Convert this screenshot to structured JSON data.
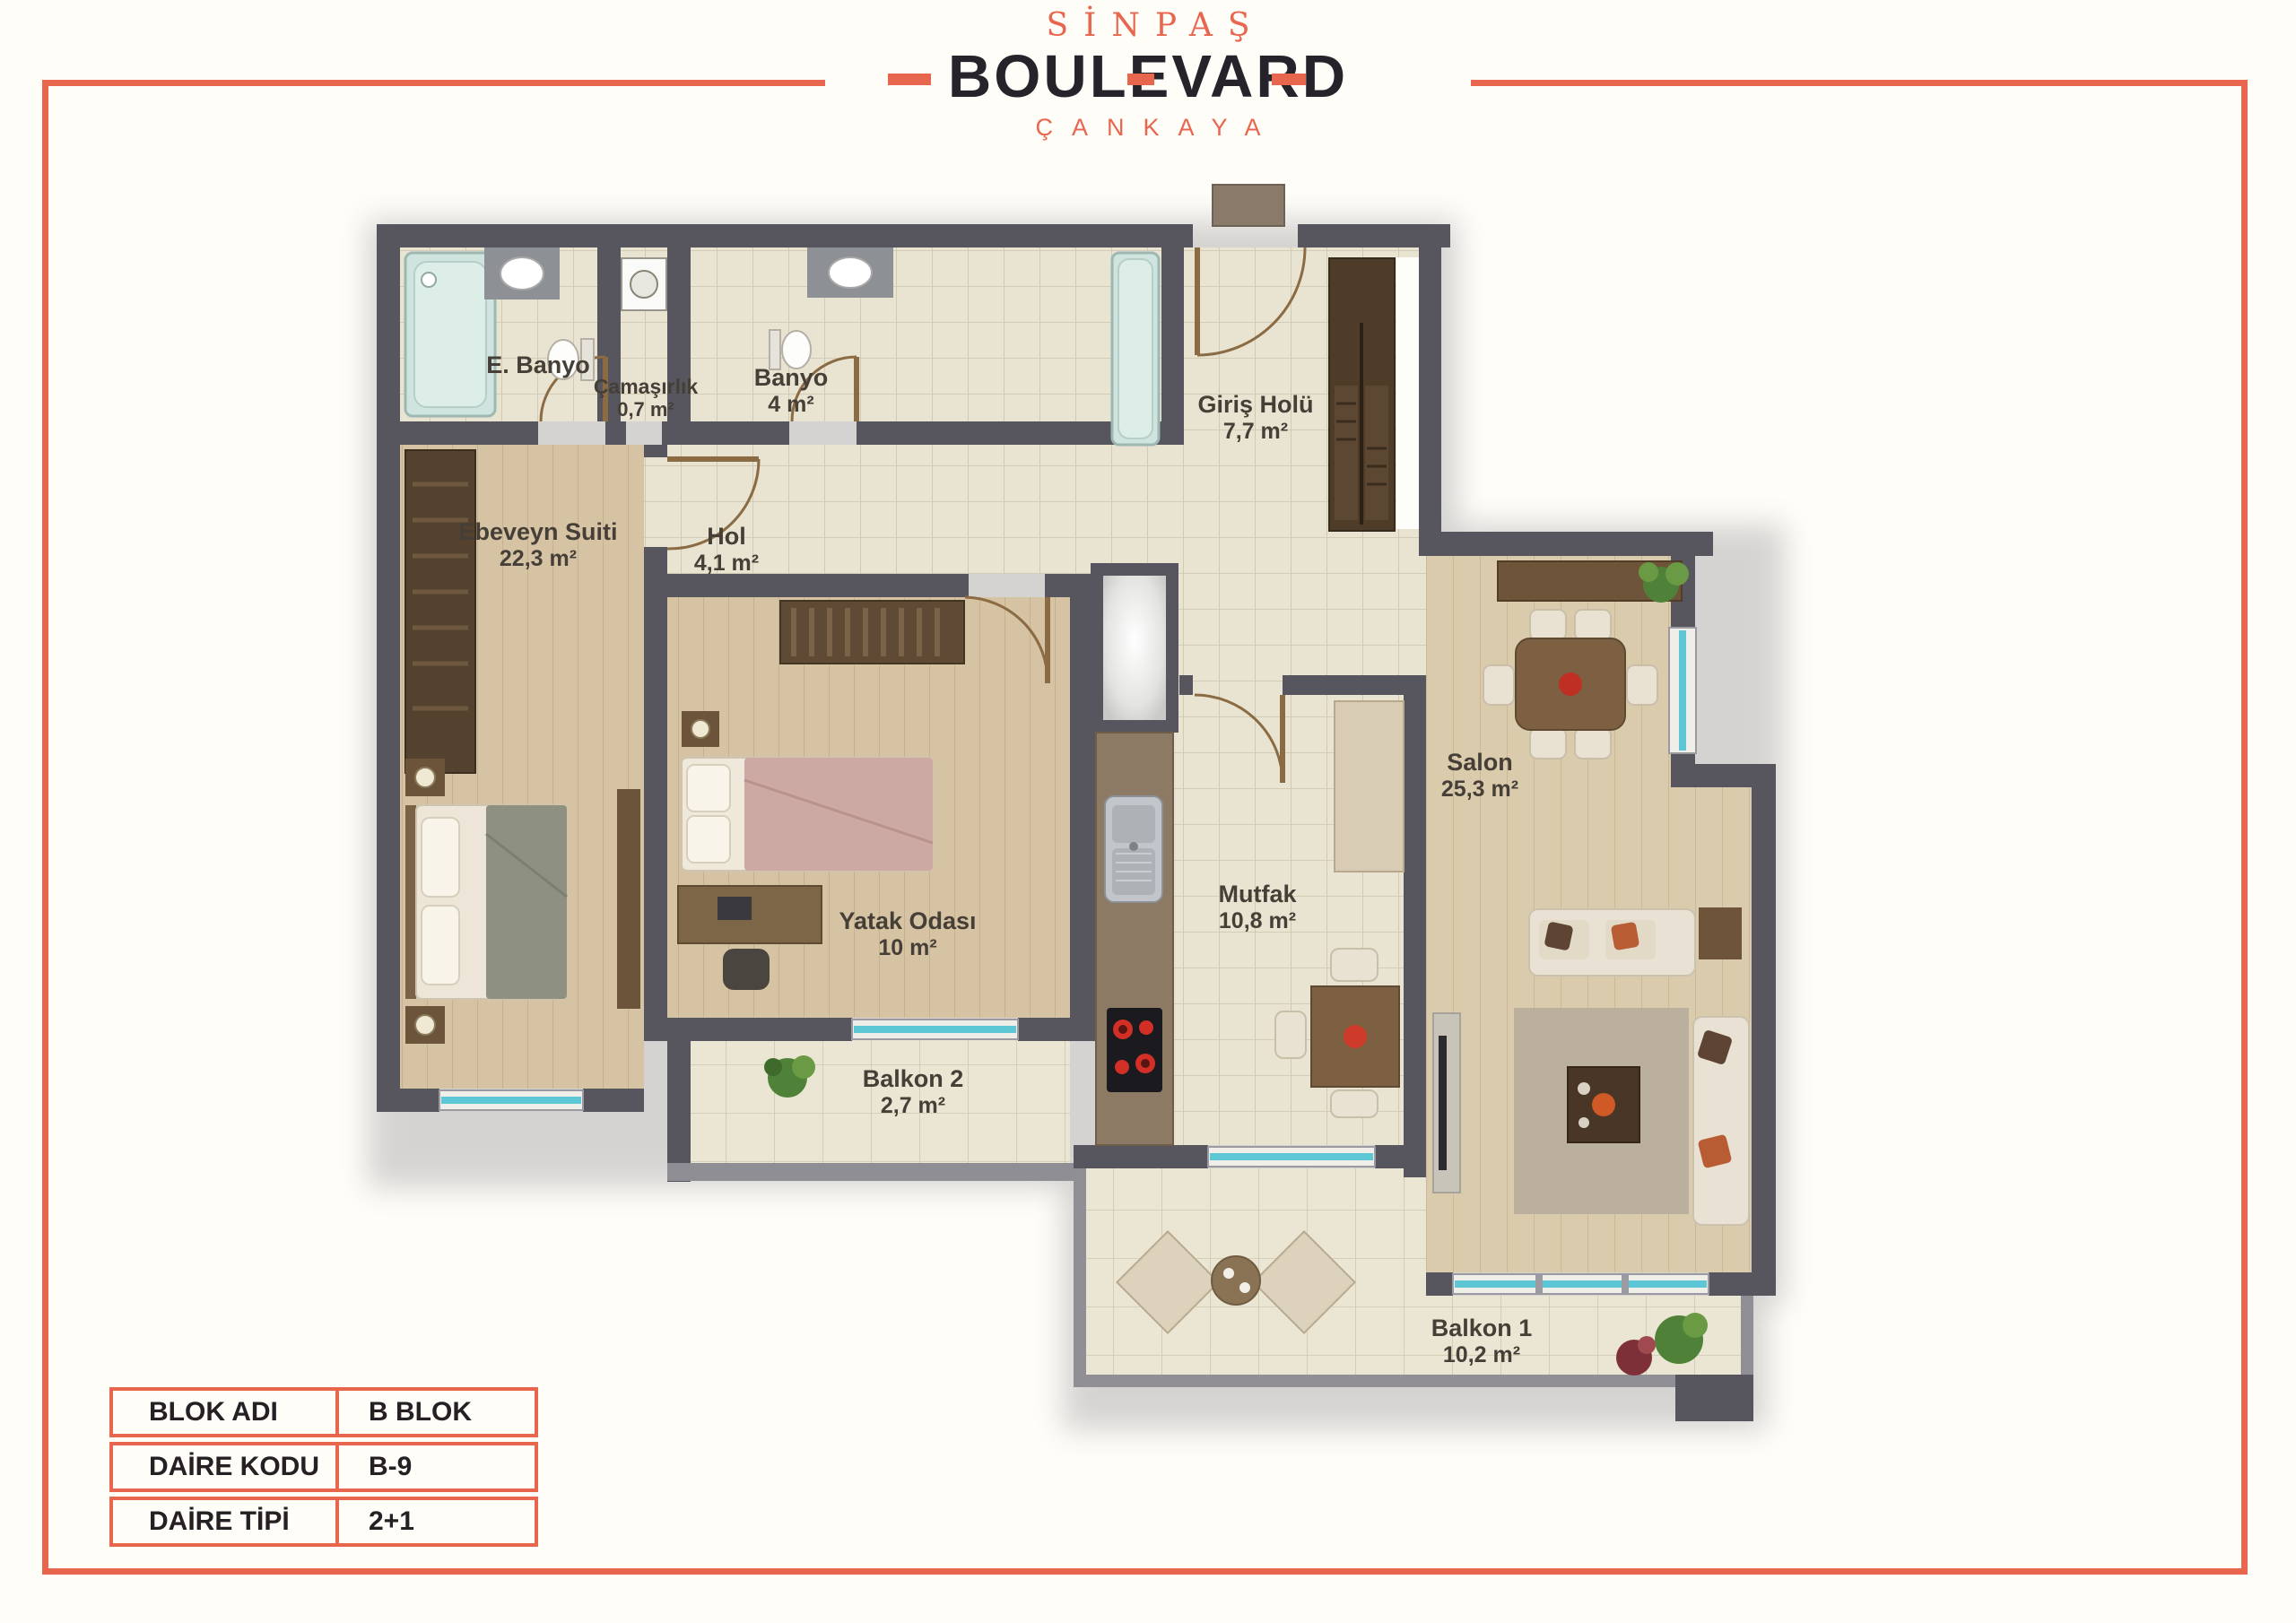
{
  "logo": {
    "brand": "SİNPAŞ",
    "name": "BOULEVARD",
    "location": "ÇANKAYA"
  },
  "floor_plan": {
    "rooms": [
      {
        "name": "E. Banyo",
        "area": ""
      },
      {
        "name": "Çamaşırlık",
        "area": "0,7 m²"
      },
      {
        "name": "Banyo",
        "area": "4 m²"
      },
      {
        "name": "Giriş Holü",
        "area": "7,7 m²"
      },
      {
        "name": "Hol",
        "area": "4,1 m²"
      },
      {
        "name": "Ebeveyn Suiti",
        "area": "22,3 m²"
      },
      {
        "name": "Yatak Odası",
        "area": "10 m²"
      },
      {
        "name": "Mutfak",
        "area": "10,8 m²"
      },
      {
        "name": "Salon",
        "area": "25,3 m²"
      },
      {
        "name": "Balkon 2",
        "area": "2,7 m²"
      },
      {
        "name": "Balkon 1",
        "area": "10,2 m²"
      }
    ]
  },
  "info_table": {
    "rows": [
      {
        "label": "BLOK ADI",
        "value": "B BLOK"
      },
      {
        "label": "DAİRE KODU",
        "value": "B-9"
      },
      {
        "label": "DAİRE TİPİ",
        "value": "2+1"
      }
    ]
  },
  "colors": {
    "accent_coral": "#E8654E",
    "logo_black": "#26232B",
    "wall_gray": "#57565E",
    "tile_floor": "#E9E3D1",
    "wood_floor": "#D6C3A4",
    "window_glass": "#5EC7D6",
    "background": "#FFFDF8"
  }
}
